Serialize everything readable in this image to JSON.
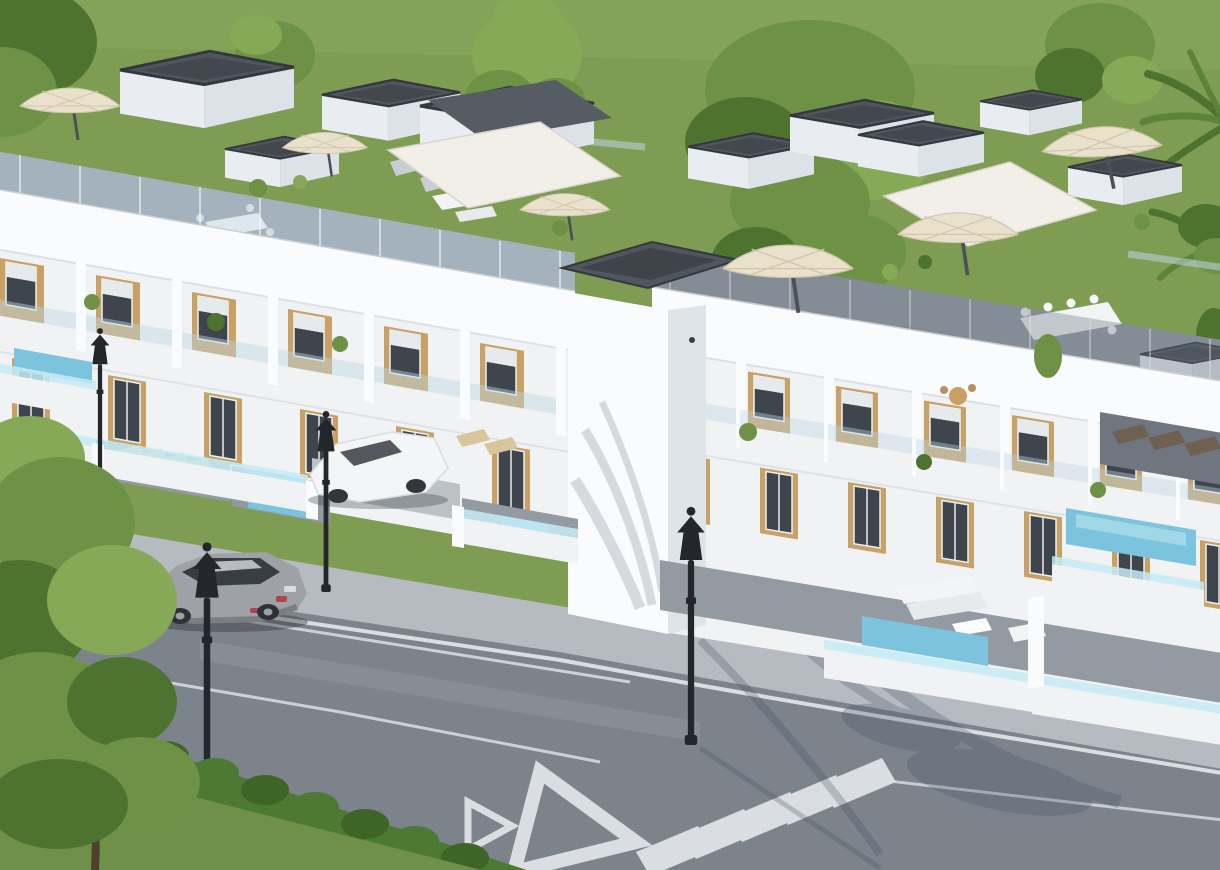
{
  "scene": {
    "type": "3d-architectural-render",
    "subject": "Aerial daytime rendering of a new-build complex of white townhouses with wood-clad facades, rooftop terraces with parasols and awnings, private plunge pools, a corner street with crosswalk and yield markings, two cars, classic street lamps, hedge and trees",
    "objects": {
      "building": {
        "wings": 2,
        "storeys": 3,
        "facade_materials": [
          "white-render",
          "wood-cladding",
          "glass-balustrade"
        ]
      },
      "rooftop_features": [
        "stair-bulkheads-gravel-roof",
        "cream-parasols",
        "white-awnings",
        "dark-awning",
        "outdoor-dining-sets",
        "sun-loungers",
        "glass-railings",
        "planters"
      ],
      "pools": {
        "count": 5,
        "style": "private-plunge-pool"
      },
      "vehicles": [
        {
          "type": "sports-car",
          "color_key": "car_silver",
          "location": "street"
        },
        {
          "type": "compact-car",
          "color_key": "car_white",
          "location": "driveway"
        }
      ],
      "street_lamps": {
        "count": 4,
        "style": "classic-black-lantern"
      },
      "road_markings": [
        "white-edge-lines",
        "lane-lines",
        "zebra-crosswalk",
        "yield-triangle-small",
        "yield-triangle-large"
      ],
      "vegetation": [
        "grass-field",
        "background-trees",
        "palm-tree",
        "foreground-tree",
        "hedge-row",
        "terrace-plants",
        "lawn"
      ]
    },
    "palette": {
      "grass": "#7E9C52",
      "grass_light": "#8FAC60",
      "lawn": "#6E9048",
      "tree_green": "#6D9145",
      "tree_light": "#85A957",
      "tree_dark": "#4E7330",
      "hedge": "#4C7A33",
      "hedge_dark": "#3E6428",
      "trunk_brown": "#4F3F2B",
      "white_wall": "#F0F2F4",
      "white_bright": "#FAFBFD",
      "white_shadow": "#DFE4E9",
      "wood": "#C7A166",
      "window_glass": "#3F454D",
      "shutter_white": "#E7EAED",
      "glass_rail": "#BCD6E3",
      "glass_dark": "#6A747E",
      "pool_water": "#7CC4DD",
      "pool_glass": "#C5EBF4",
      "roof_gravel": "#51565E",
      "roof_gravel_dark": "#33383F",
      "terrace_tile": "#939AA2",
      "tile_light": "#BCC1C6",
      "tile_dark": "#6F7680",
      "road_asphalt": "#7C838B",
      "road_dark": "#646B73",
      "sidewalk_gray": "#B5BBC1",
      "road_marking": "#E2E6EA",
      "umbrella_cream": "#EAE1CC",
      "awning_white": "#F1EFE7",
      "awning_dark": "#565C64",
      "car_silver": "#9EA2A7",
      "car_silver_dark": "#7B7F84",
      "car_glass": "#383D44",
      "taillight_red": "#B2434A",
      "car_white": "#F3F5F7",
      "lamp_black": "#23262B",
      "shadow_blue": "#415060",
      "furniture_white": "#F2F4F6",
      "lounger_beige": "#D9C59C",
      "lounger_brown": "#6F6051"
    }
  }
}
